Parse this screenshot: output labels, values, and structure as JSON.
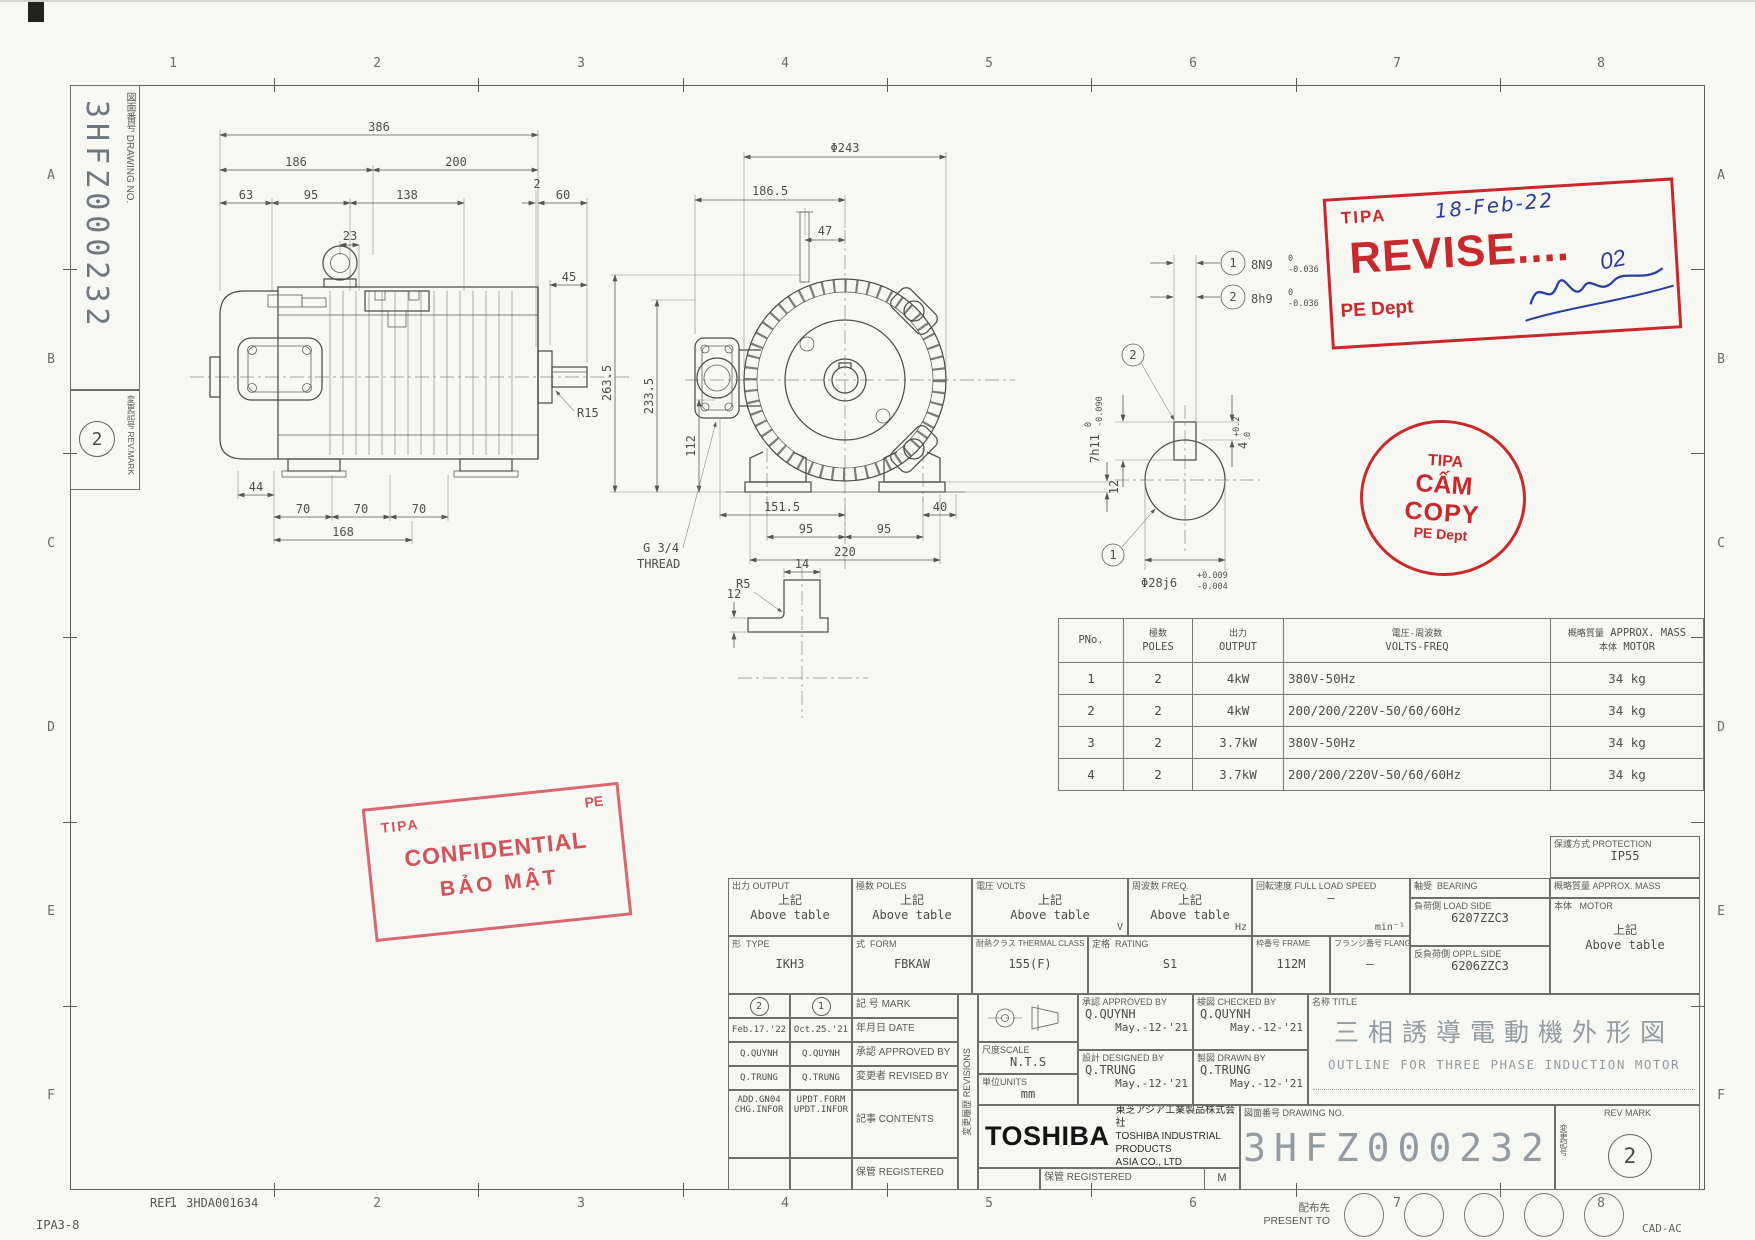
{
  "page": {
    "ref": "REF. 3HDA001634",
    "form_no": "IPA3-8",
    "cad": "CAD-AC"
  },
  "zones": {
    "cols": [
      "1",
      "2",
      "3",
      "4",
      "5",
      "6",
      "7",
      "8"
    ],
    "rows": [
      "A",
      "B",
      "C",
      "D",
      "E",
      "F"
    ]
  },
  "side_block": {
    "drawing_no_label": "図面番号 DRAWING NO.",
    "drawing_no": "3HFZ000232",
    "rev_label": "変更記号 REV.MARK",
    "rev": "2"
  },
  "stamps": {
    "revise": {
      "org": "TIPA",
      "date": "18-Feb-22",
      "word": "REVISE....",
      "number": "02",
      "dept": "PE Dept"
    },
    "nocopy": {
      "l1": "TIPA",
      "l2": "CẤM",
      "l3": "COPY",
      "l4": "PE Dept"
    },
    "confidential": {
      "org": "TIPA",
      "corner": "PE",
      "l1": "CONFIDENTIAL",
      "l2": "BẢO MẬT"
    }
  },
  "spec_table": {
    "h_pno": "PNo.",
    "h_poles_jp": "極数",
    "h_poles": "POLES",
    "h_output_jp": "出力",
    "h_output": "OUTPUT",
    "h_volts_jp": "電圧-周波数",
    "h_volts": "VOLTS-FREQ",
    "h_mass_jp": "概略質量",
    "h_mass": "APPROX. MASS",
    "h_mass2_jp": "本体",
    "h_mass2": "MOTOR",
    "rows": [
      {
        "pno": "1",
        "poles": "2",
        "output": "4kW",
        "volts": "380V-50Hz",
        "mass": "34 kg"
      },
      {
        "pno": "2",
        "poles": "2",
        "output": "4kW",
        "volts": "200/200/220V-50/60/60Hz",
        "mass": "34 kg"
      },
      {
        "pno": "3",
        "poles": "2",
        "output": "3.7kW",
        "volts": "380V-50Hz",
        "mass": "34 kg"
      },
      {
        "pno": "4",
        "poles": "2",
        "output": "3.7kW",
        "volts": "200/200/220V-50/60/60Hz",
        "mass": "34 kg"
      }
    ]
  },
  "side_view": {
    "d386": "386",
    "d186": "186",
    "d200": "200",
    "d63": "63",
    "d95": "95",
    "d138": "138",
    "d2": "2",
    "d60": "60",
    "d23": "23",
    "d45": "45",
    "r15": "R15",
    "d44": "44",
    "d70a": "70",
    "d70b": "70",
    "d70c": "70",
    "d168": "168"
  },
  "front_view": {
    "dia243": "Φ243",
    "d1865": "186.5",
    "d47": "47",
    "d2635": "263.5",
    "d2335": "233.5",
    "d112": "112",
    "d12": "12",
    "d1515": "151.5",
    "d95a": "95",
    "d95b": "95",
    "d220": "220",
    "d40": "40",
    "thread1": "G 3/4",
    "thread2": "THREAD"
  },
  "shaft_detail": {
    "b1": "1",
    "b1t": "8N9",
    "b1top": "0",
    "b1bot": "-0.036",
    "b2": "2",
    "b2t": "8h9",
    "b2top": "0",
    "b2bot": "-0.036",
    "p1": "1",
    "p2": "2",
    "d7": "7h11",
    "d7top": "0",
    "d7bot": "-0.090",
    "d4": "4",
    "d4top": "+0.2",
    "d4bot": "0",
    "d28": "Φ28j6",
    "d28top": "+0.009",
    "d28bot": "-0.004"
  },
  "foot_detail": {
    "r5": "R5",
    "d14": "14",
    "d12": "12"
  },
  "title_block": {
    "protection_jp": "保護方式",
    "protection_en": "PROTECTION",
    "protection_val": "IP55",
    "output_jp": "出力",
    "output_en": "OUTPUT",
    "output_v1": "上記",
    "output_v2": "Above table",
    "poles_jp": "極数",
    "poles_en": "POLES",
    "poles_v1": "上記",
    "poles_v2": "Above table",
    "volts_jp": "電圧",
    "volts_en": "VOLTS",
    "volts_v1": "上記",
    "volts_v2": "Above table",
    "volts_unit": "V",
    "freq_jp": "周波数",
    "freq_en": "FREQ.",
    "freq_v1": "上記",
    "freq_v2": "Above table",
    "freq_unit": "Hz",
    "speed_jp": "回転速度",
    "speed_en": "FULL LOAD SPEED",
    "speed_val": "–",
    "speed_unit": "min⁻¹",
    "bearing_jp": "軸受",
    "bearing_en": "BEARING",
    "load_jp": "負荷側",
    "load_en": "LOAD SIDE",
    "load_val": "6207ZZC3",
    "opp_jp": "反負荷側",
    "opp_en": "OPP.L.SIDE",
    "opp_val": "6206ZZC3",
    "mass_jp": "概略質量",
    "mass_en": "APPROX. MASS",
    "motor_jp": "本体",
    "motor_en": "MOTOR",
    "mass_v1": "上記",
    "mass_v2": "Above table",
    "type_jp": "形",
    "type_en": "TYPE",
    "type_val": "IKH3",
    "form_jp": "式",
    "form_en": "FORM",
    "form_val": "FBKAW",
    "thermal_jp": "耐熱クラス",
    "thermal_en": "THERMAL CLASS",
    "thermal_val": "155(F)",
    "rating_jp": "定格",
    "rating_en": "RATING",
    "rating_val": "S1",
    "frame_jp": "枠番号",
    "frame_en": "FRAME",
    "frame_val": "112M",
    "flange_jp": "フランジ番号",
    "flange_en": "FLANGE",
    "flange_val": "–",
    "mark_jp": "記  号",
    "mark_en": "MARK",
    "date_jp": "年月日",
    "date_en": "DATE",
    "appr_jp": "承認",
    "appr_en": "APPROVED BY",
    "revby_jp": "変更者",
    "revby_en": "REVISED BY",
    "contents_jp": "記事",
    "contents_en": "CONTENTS",
    "reg_jp": "保管",
    "reg_en": "REGISTERED",
    "rev2_no": "2",
    "rev1_no": "1",
    "rev2_date": "Feb.17.'22",
    "rev1_date": "Oct.25.'21",
    "rev2_appr": "Q.QUYNH",
    "rev1_appr": "Q.QUYNH",
    "rev2_by": "Q.TRUNG",
    "rev1_by": "Q.TRUNG",
    "rev2_c1": "ADD.GN04",
    "rev2_c2": "CHG.INFOR",
    "rev1_c1": "UPDT.FORM",
    "rev1_c2": "UPDT.INFOR",
    "revisions_jp": "変更履歴",
    "revisions_label": "REVISIONS",
    "scale_jp": "尺度",
    "scale_en": "SCALE",
    "scale_val": "N.T.S",
    "units_jp": "単位",
    "units_en": "UNITS",
    "units_val": "mm",
    "approved_jp": "承認",
    "approved_en": "APPROVED BY",
    "approved_name": "Q.QUYNH",
    "approved_date": "May.-12-'21",
    "checked_jp": "検図",
    "checked_en": "CHECKED BY",
    "checked_name": "Q.QUYNH",
    "checked_date": "May.-12-'21",
    "designed_jp": "設計",
    "designed_en": "DESIGNED BY",
    "designed_name": "Q.TRUNG",
    "designed_date": "May.-12-'21",
    "drawn_jp": "製図",
    "drawn_en": "DRAWN BY",
    "drawn_name": "Q.TRUNG",
    "drawn_date": "May.-12-'21",
    "title_jp_label": "名称",
    "title_en_label": "TITLE",
    "title_jp": "三相誘導電動機外形図",
    "title_en": "OUTLINE FOR THREE PHASE INDUCTION MOTOR",
    "company_logo": "TOSHIBA",
    "company_jp": "東芝アジア工業製品株式会社",
    "company_en1": "TOSHIBA INDUSTRIAL PRODUCTS",
    "company_en2": "ASIA CO., LTD",
    "registered_m": "M",
    "drawno_jp": "図面番号",
    "drawno_en": "DRAWING NO.",
    "drawno_val": "3HFZ000232",
    "revmark_jp": "変更記号",
    "revmark_en": "REV MARK",
    "revmark_val": "2",
    "present_jp": "配布先",
    "present_en": "PRESENT TO"
  }
}
